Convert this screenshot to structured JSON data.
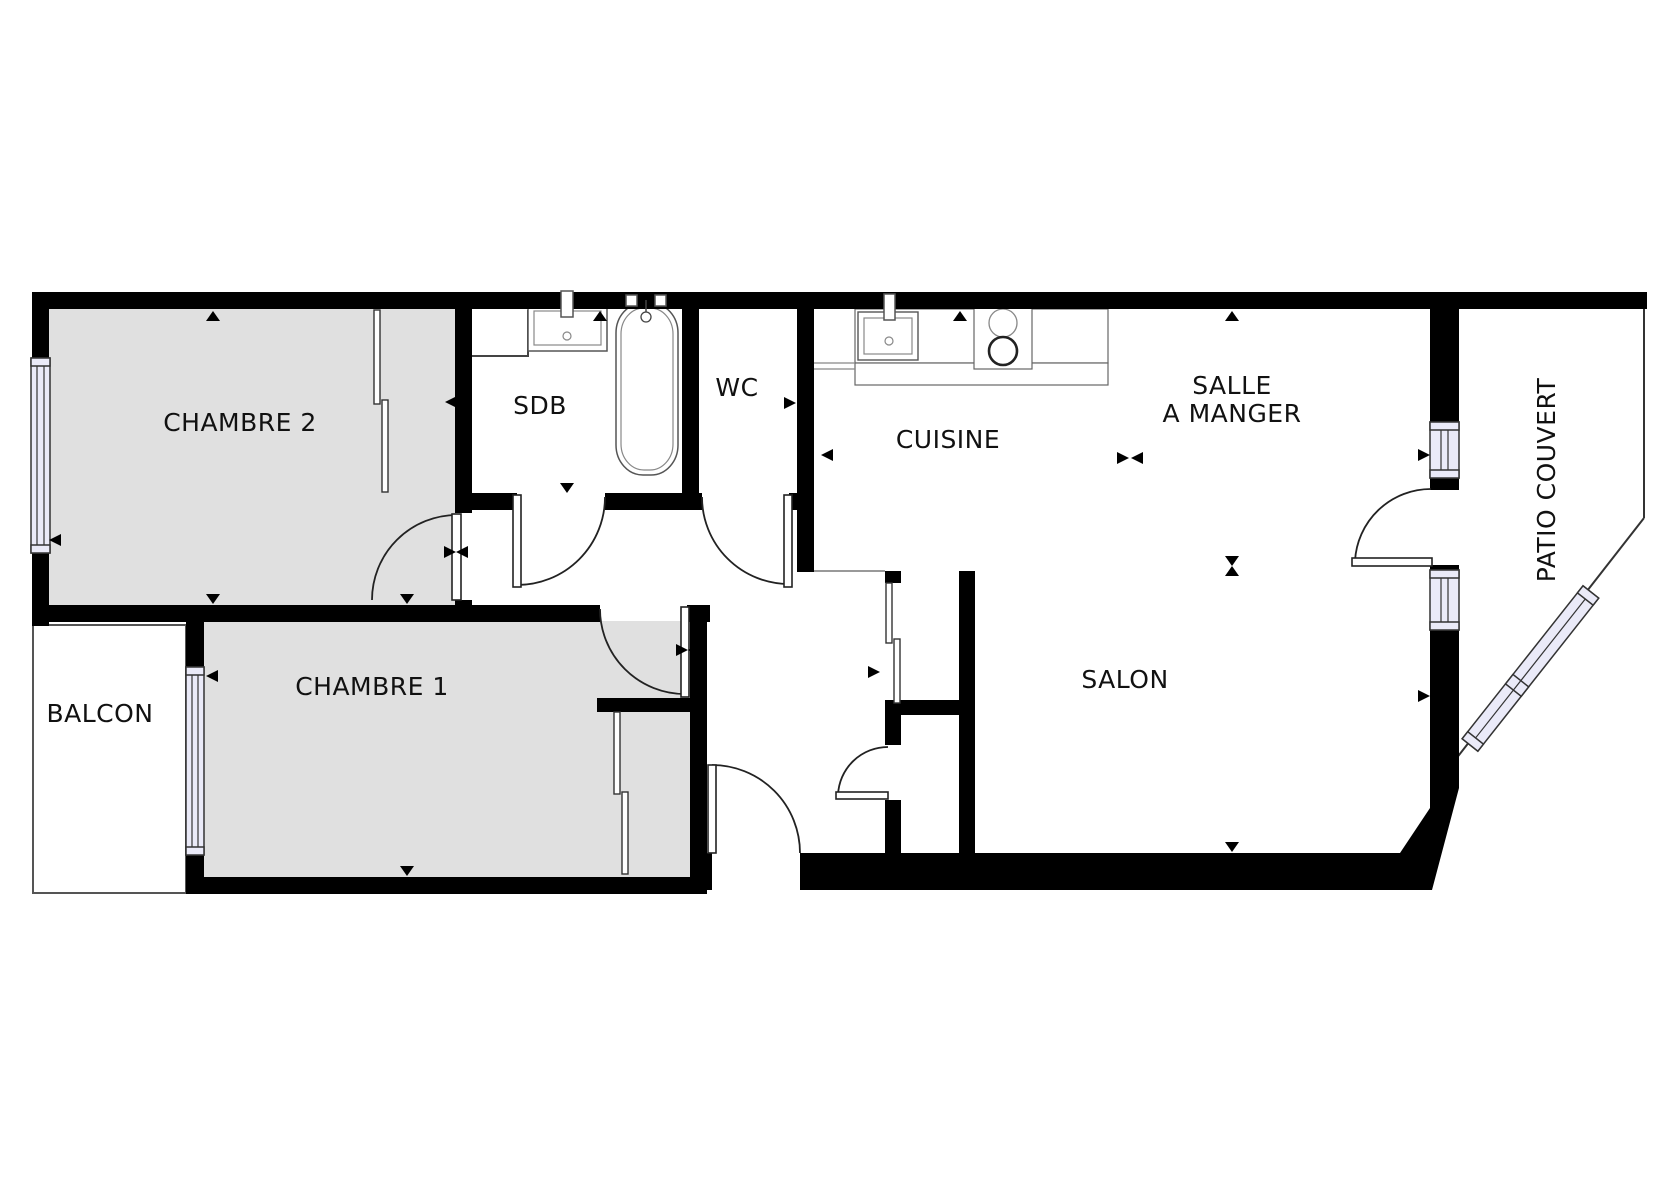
{
  "plan": {
    "rooms": {
      "chambre2": "CHAMBRE 2",
      "sdb": "SDB",
      "wc": "WC",
      "cuisine": "CUISINE",
      "salle_a_manger_line1": "SALLE",
      "salle_a_manger_line2": "A MANGER",
      "salon": "SALON",
      "chambre1": "CHAMBRE 1",
      "balcon": "BALCON",
      "patio": "PATIO COUVERT"
    },
    "colors": {
      "wall": "#000000",
      "room_fill_grey": "#e0e0e0",
      "window_fill": "#eaeaf8",
      "outline": "#333333"
    }
  }
}
